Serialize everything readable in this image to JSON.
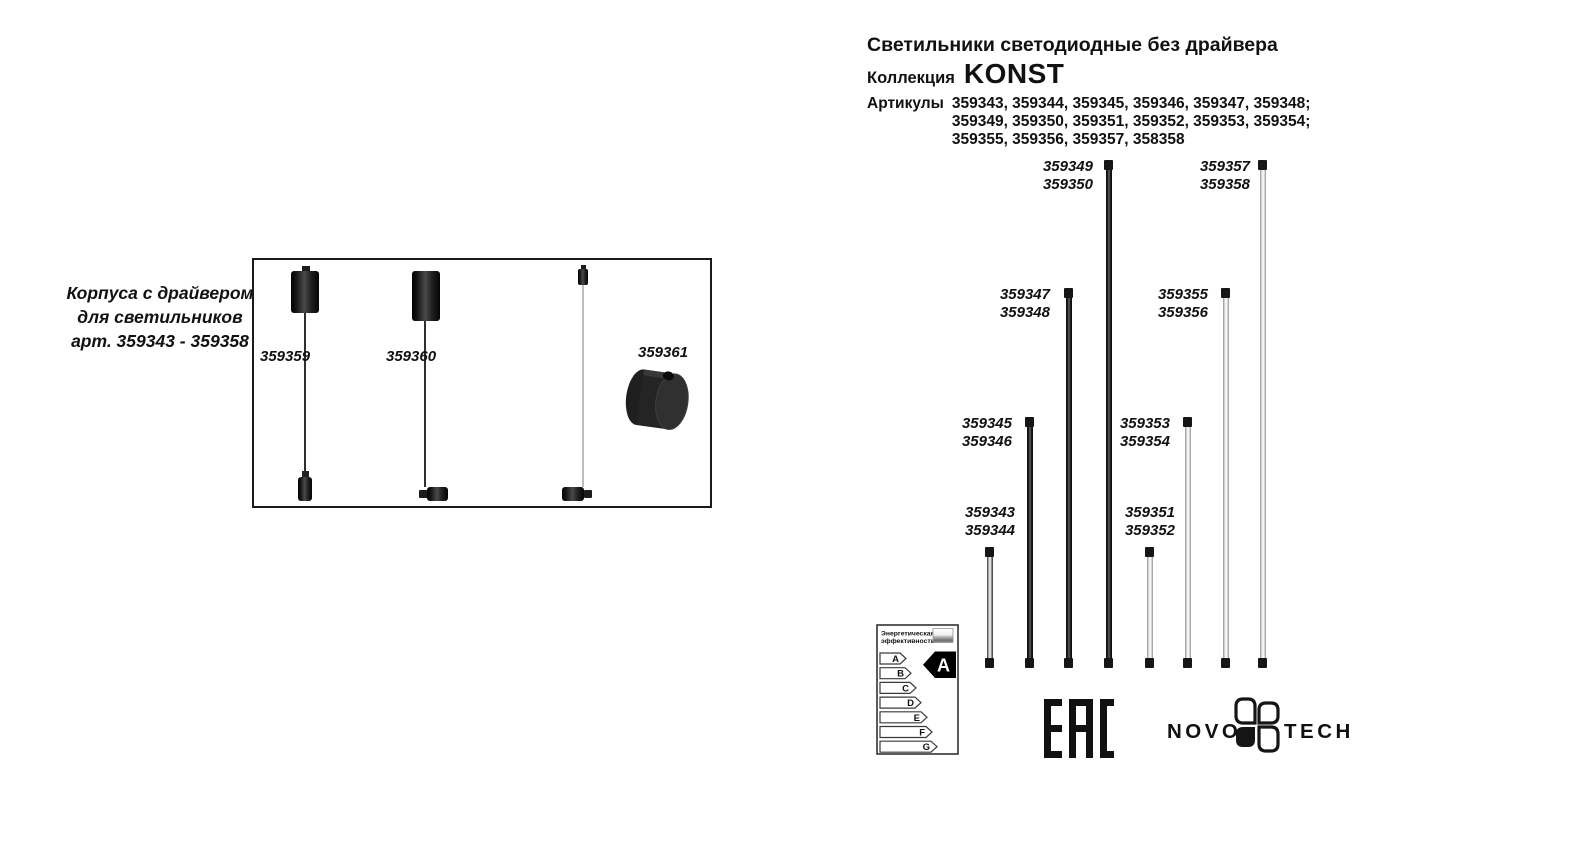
{
  "header": {
    "title": "Светильники светодиодные без драйвера",
    "collection_label": "Коллекция",
    "collection_name": "KONST",
    "articles_label": "Артикулы",
    "articles_lines": [
      "359343, 359344, 359345, 359346, 359347, 359348;",
      "359349, 359350, 359351, 359352, 359353, 359354;",
      "359355, 359356, 359357, 358358"
    ]
  },
  "left_panel": {
    "caption_lines": [
      "Корпуса с драйвером",
      "для светильников",
      "арт. 359343 - 359358"
    ],
    "item_labels": [
      "359359",
      "359360",
      "359361"
    ]
  },
  "diagram": {
    "tubes": [
      {
        "line1": "359343",
        "line2": "359344"
      },
      {
        "line1": "359345",
        "line2": "359346"
      },
      {
        "line1": "359347",
        "line2": "359348"
      },
      {
        "line1": "359349",
        "line2": "359350"
      },
      {
        "line1": "359351",
        "line2": "359352"
      },
      {
        "line1": "359353",
        "line2": "359354"
      },
      {
        "line1": "359355",
        "line2": "359356"
      },
      {
        "line1": "359357",
        "line2": "359358"
      }
    ]
  },
  "energy_label": {
    "title_line1": "Энергетическая",
    "title_line2": "эффективность",
    "classes": [
      "A",
      "B",
      "C",
      "D",
      "E",
      "F",
      "G"
    ],
    "rating": "A"
  },
  "logos": {
    "eac": "EAC",
    "novotech_left": "NOVO",
    "novotech_right": "TECH"
  },
  "colors": {
    "ink": "#111111",
    "tube_dark": "#141414",
    "tube_light": "#e8e8e8"
  }
}
